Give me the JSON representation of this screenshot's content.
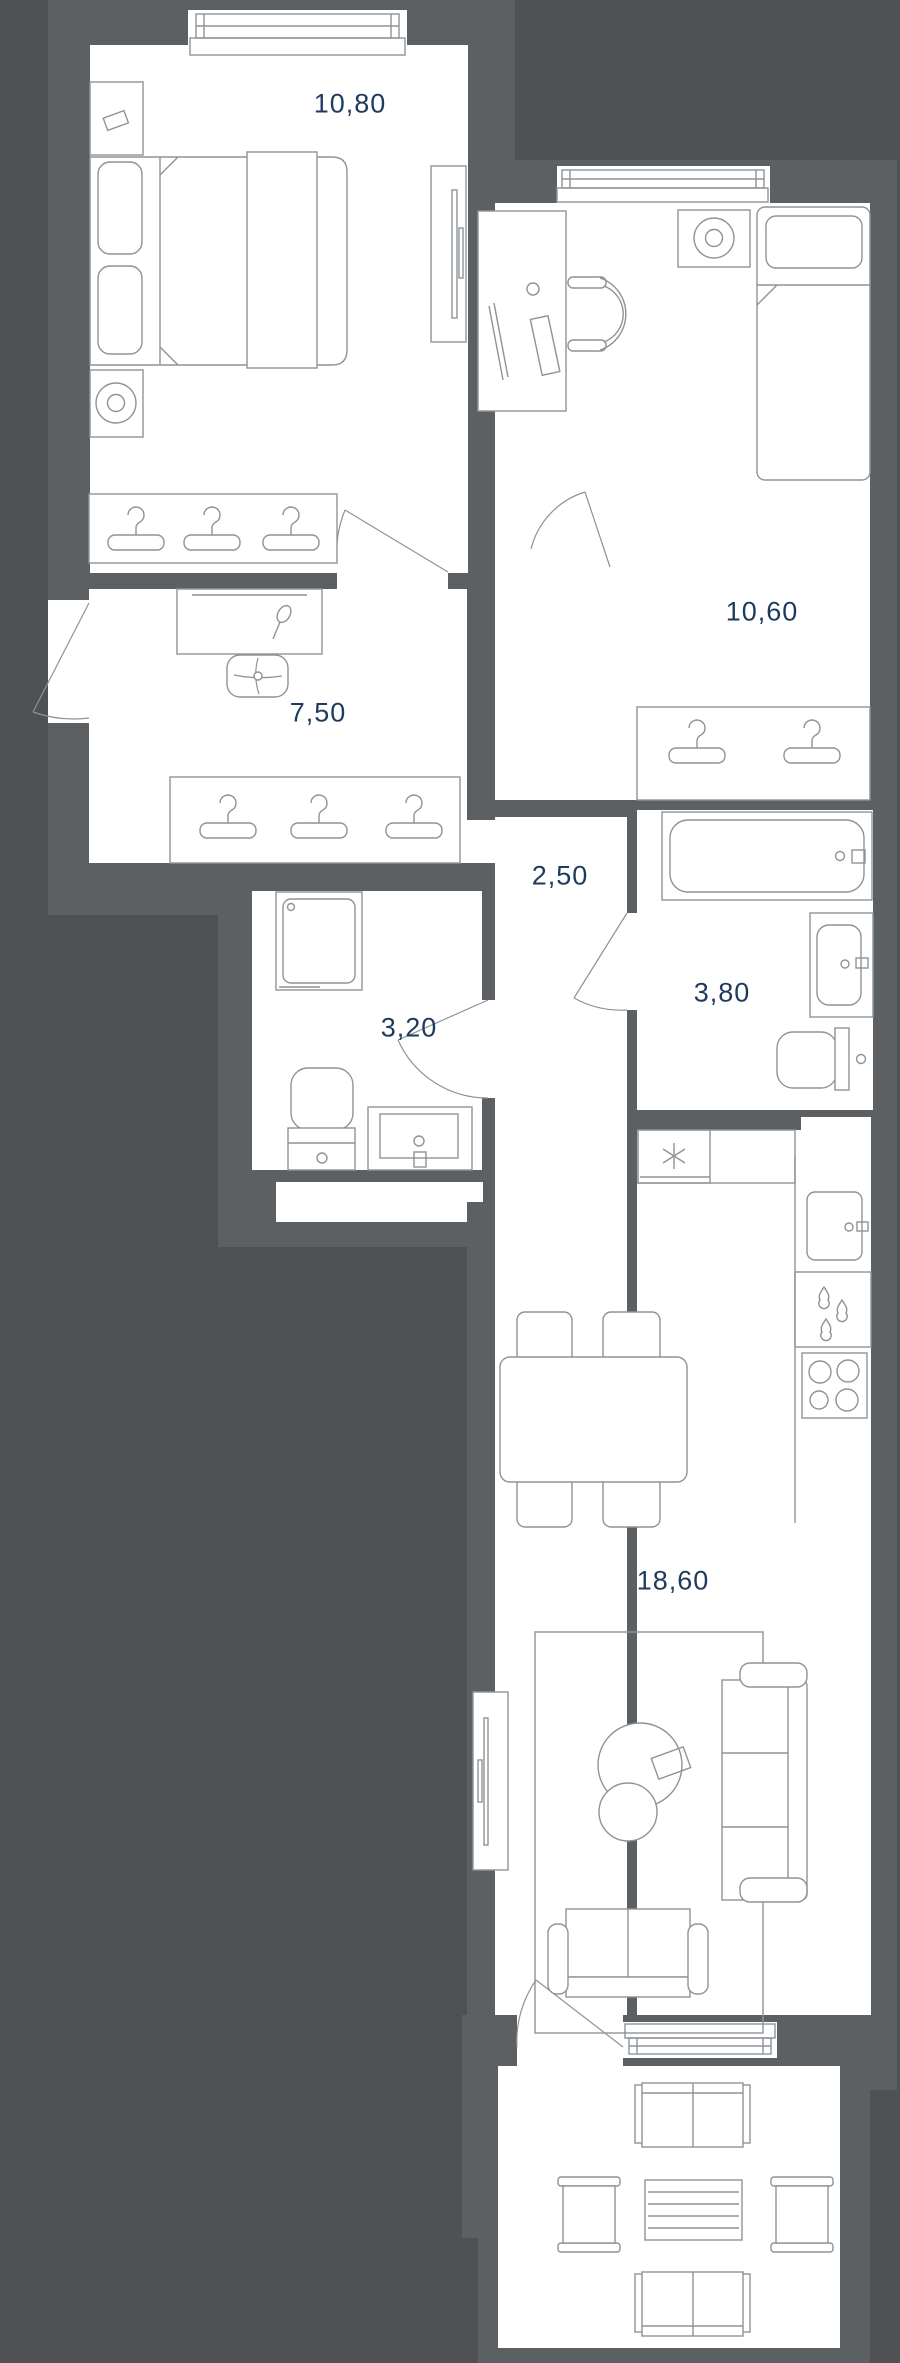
{
  "floor_plan": {
    "rooms": [
      {
        "name": "bedroom-1",
        "area": "10,80"
      },
      {
        "name": "bedroom-2",
        "area": "10,60"
      },
      {
        "name": "hallway",
        "area": "7,50"
      },
      {
        "name": "corridor",
        "area": "2,50"
      },
      {
        "name": "shower-room",
        "area": "3,20"
      },
      {
        "name": "bathroom",
        "area": "3,80"
      },
      {
        "name": "living-kitchen",
        "area": "18,60"
      }
    ],
    "colors": {
      "background": "#4F5153",
      "wall": "#5D6063",
      "room": "#FFFFFF",
      "line": "#8E9397",
      "label": "#1E3A5C"
    },
    "furniture_icons": [
      "double-bed-icon",
      "nightstand-icon",
      "speaker-icon",
      "tv-icon",
      "wardrobe-icon",
      "hanger-icon",
      "dressing-table-icon",
      "stool-icon",
      "desk-icon",
      "office-chair-icon",
      "single-bed-icon",
      "shower-cabin-icon",
      "toilet-icon",
      "sink-vanity-icon",
      "bathtub-icon",
      "washing-machine-icon",
      "refrigerator-icon",
      "kitchen-sink-icon",
      "stove-icon",
      "dining-table-icon",
      "chair-icon",
      "sofa-icon",
      "loveseat-icon",
      "rug-icon",
      "coffee-table-icon",
      "bench-icon",
      "balcony-table-icon",
      "window-icon",
      "door-swing-icon"
    ]
  }
}
